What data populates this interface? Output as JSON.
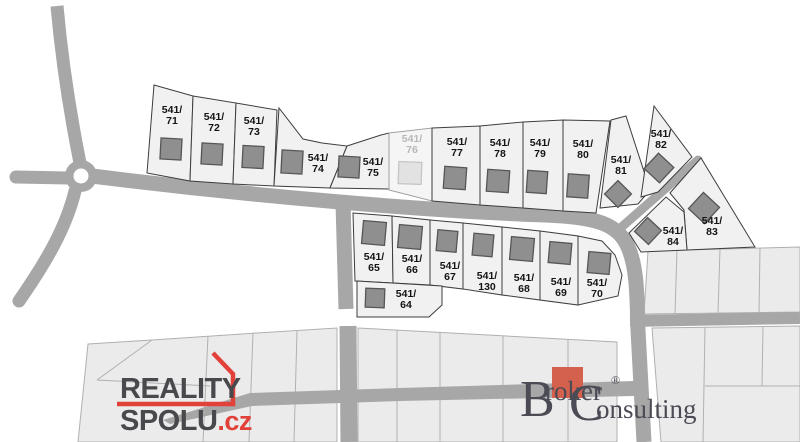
{
  "map": {
    "background": "#ffffff",
    "colors": {
      "road": "#a7a7a7",
      "plot_fill": "#f1f1f1",
      "plot_stroke": "#3d3d3d",
      "building_fill": "#8f8f8f",
      "building_stroke": "#565656",
      "label_color": "#141414",
      "sold_plot_fill": "#f5f5f5",
      "sold_plot_stroke": "#a0a0a0",
      "sold_building_fill": "#e2e2e2",
      "sold_building_stroke": "#c6c6c6",
      "sold_label_color": "#b7b7b7",
      "parcel_fill": "#ebebeb",
      "parcel_stroke": "#b0b0b0",
      "reality_red": "#e2413a",
      "broker_square": "#d4604e",
      "broker_text": "#4b4b55"
    },
    "roundabout": {
      "cx": 81,
      "cy": 176,
      "r_outer": 16,
      "r_inner": 7.5
    },
    "roads": {
      "paths": [
        {
          "d": "M 57,6 C 62,62 71,118 80,163",
          "w": 13
        },
        {
          "d": "M 16,177 L 68,178",
          "w": 13,
          "cap": "round"
        },
        {
          "d": "M 75,191 C 66,228 46,262 19,301",
          "w": 13,
          "cap": "round"
        },
        {
          "d": "M 92,176 C 260,197 430,211 545,215 C 597,217 618,224 628,247 C 637,267 637,295 638,330 L 644,442",
          "w": 15
        },
        {
          "d": "M 343,203 L 346,309",
          "w": 15
        },
        {
          "d": "M 348,326 L 349,442",
          "w": 17
        },
        {
          "d": "M 617,231 L 698,160",
          "w": 9,
          "cap": "round"
        },
        {
          "d": "M 630,321 L 800,318",
          "w": 12
        }
      ],
      "taper_road": [
        [
          163,
          420
        ],
        [
          250,
          393
        ],
        [
          400,
          388
        ],
        [
          634,
          381
        ],
        [
          634,
          396
        ],
        [
          400,
          401
        ],
        [
          252,
          406
        ],
        [
          170,
          424
        ]
      ]
    },
    "parcels": {
      "regions": [
        {
          "pts": [
            [
              88,
              344
            ],
            [
              152,
              340
            ],
            [
              257,
              333
            ],
            [
              337,
              328
            ],
            [
              337,
              442
            ],
            [
              78,
              442
            ]
          ]
        },
        {
          "pts": [
            [
              358,
              328
            ],
            [
              617,
              342
            ],
            [
              617,
              442
            ],
            [
              358,
              442
            ]
          ]
        },
        {
          "pts": [
            [
              648,
              251
            ],
            [
              800,
              247
            ],
            [
              800,
              312
            ],
            [
              644,
              314
            ]
          ]
        },
        {
          "pts": [
            [
              652,
              328
            ],
            [
              800,
              326
            ],
            [
              800,
              442
            ],
            [
              661,
              442
            ]
          ]
        }
      ],
      "lines": [
        [
          [
            152,
            340
          ],
          [
            97,
            380
          ]
        ],
        [
          [
            97,
            380
          ],
          [
            210,
            386
          ]
        ],
        [
          [
            208,
            336
          ],
          [
            203,
            442
          ]
        ],
        [
          [
            253,
            333
          ],
          [
            249,
            442
          ]
        ],
        [
          [
            297,
            331
          ],
          [
            294,
            442
          ]
        ],
        [
          [
            397,
            330
          ],
          [
            397,
            442
          ]
        ],
        [
          [
            440,
            333
          ],
          [
            440,
            442
          ]
        ],
        [
          [
            503,
            336
          ],
          [
            503,
            442
          ]
        ],
        [
          [
            568,
            340
          ],
          [
            568,
            442
          ]
        ],
        [
          [
            677,
            250
          ],
          [
            675,
            313
          ]
        ],
        [
          [
            720,
            249
          ],
          [
            718,
            313
          ]
        ],
        [
          [
            760,
            248
          ],
          [
            759,
            313
          ]
        ],
        [
          [
            705,
            327
          ],
          [
            703,
            442
          ]
        ],
        [
          [
            763,
            327
          ],
          [
            762,
            386
          ]
        ],
        [
          [
            705,
            386
          ],
          [
            800,
            386
          ]
        ]
      ]
    },
    "plots": [
      {
        "label": "541/71",
        "prefix": "541/",
        "suffix": "71",
        "status": "available",
        "poly": [
          [
            154,
            85
          ],
          [
            193,
            96
          ],
          [
            190,
            181
          ],
          [
            147,
            173
          ]
        ],
        "lbl": [
          172,
          113
        ],
        "bld": [
          171,
          149,
          21,
          21,
          3
        ]
      },
      {
        "label": "541/72",
        "prefix": "541/",
        "suffix": "72",
        "status": "available",
        "poly": [
          [
            193,
            96
          ],
          [
            236,
            103
          ],
          [
            233,
            184
          ],
          [
            190,
            181
          ]
        ],
        "lbl": [
          214,
          120
        ],
        "bld": [
          212,
          154,
          21,
          21,
          3
        ]
      },
      {
        "label": "541/73",
        "prefix": "541/",
        "suffix": "73",
        "status": "available",
        "poly": [
          [
            236,
            103
          ],
          [
            277,
            110
          ],
          [
            274,
            186
          ],
          [
            233,
            184
          ]
        ],
        "lbl": [
          254,
          124
        ],
        "bld": [
          253,
          157,
          21,
          22,
          3
        ]
      },
      {
        "label": "541/74",
        "prefix": "541/",
        "suffix": "74",
        "status": "available",
        "poly": [
          [
            279,
            108
          ],
          [
            303,
            139
          ],
          [
            322,
            143
          ],
          [
            347,
            146
          ],
          [
            330,
            188
          ],
          [
            274,
            186
          ]
        ],
        "lbl": [
          318,
          161
        ],
        "bld": [
          292,
          162,
          21,
          23,
          3
        ]
      },
      {
        "label": "541/75",
        "prefix": "541/",
        "suffix": "75",
        "status": "available",
        "poly": [
          [
            347,
            146
          ],
          [
            381,
            135
          ],
          [
            389,
            133
          ],
          [
            389,
            189
          ],
          [
            330,
            188
          ]
        ],
        "lbl": [
          373,
          165
        ],
        "bld": [
          349,
          167,
          21,
          21,
          3
        ]
      },
      {
        "label": "541/76",
        "prefix": "541/",
        "suffix": "76",
        "status": "sold",
        "poly": [
          [
            389,
            133
          ],
          [
            432,
            128
          ],
          [
            432,
            201
          ],
          [
            389,
            190
          ]
        ],
        "lbl": [
          412,
          142
        ],
        "bld": [
          410,
          173,
          23,
          22,
          2
        ]
      },
      {
        "label": "541/77",
        "prefix": "541/",
        "suffix": "77",
        "status": "available",
        "poly": [
          [
            432,
            128
          ],
          [
            480,
            126
          ],
          [
            480,
            205
          ],
          [
            432,
            201
          ]
        ],
        "lbl": [
          457,
          145
        ],
        "bld": [
          455,
          178,
          22,
          22,
          4
        ]
      },
      {
        "label": "541/78",
        "prefix": "541/",
        "suffix": "78",
        "status": "available",
        "poly": [
          [
            480,
            126
          ],
          [
            523,
            122
          ],
          [
            523,
            208
          ],
          [
            480,
            205
          ]
        ],
        "lbl": [
          500,
          146
        ],
        "bld": [
          498,
          181,
          22,
          22,
          4
        ]
      },
      {
        "label": "541/79",
        "prefix": "541/",
        "suffix": "79",
        "status": "available",
        "poly": [
          [
            523,
            122
          ],
          [
            563,
            120
          ],
          [
            563,
            211
          ],
          [
            523,
            208
          ]
        ],
        "lbl": [
          540,
          146
        ],
        "bld": [
          537,
          182,
          20,
          22,
          4
        ]
      },
      {
        "label": "541/80",
        "prefix": "541/",
        "suffix": "80",
        "status": "available",
        "poly": [
          [
            563,
            120
          ],
          [
            610,
            121
          ],
          [
            596,
            213
          ],
          [
            563,
            211
          ]
        ],
        "lbl": [
          583,
          147
        ],
        "bld": [
          578,
          186,
          21,
          23,
          4
        ]
      },
      {
        "label": "541/81",
        "prefix": "541/",
        "suffix": "81",
        "status": "available",
        "poly": [
          [
            611,
            120
          ],
          [
            626,
            116
          ],
          [
            650,
            190
          ],
          [
            638,
            204
          ],
          [
            600,
            208
          ]
        ],
        "lbl": [
          621,
          163
        ],
        "bld": [
          618,
          194,
          19,
          19,
          45
        ]
      },
      {
        "label": "541/82",
        "prefix": "541/",
        "suffix": "82",
        "status": "available",
        "poly": [
          [
            654,
            106
          ],
          [
            692,
            157
          ],
          [
            658,
            192
          ],
          [
            641,
            197
          ]
        ],
        "lbl": [
          661,
          137
        ],
        "bld": [
          659,
          168,
          21,
          21,
          43
        ]
      },
      {
        "label": "541/83",
        "prefix": "541/",
        "suffix": "83",
        "status": "available",
        "poly": [
          [
            670,
            193
          ],
          [
            701,
            158
          ],
          [
            755,
            247
          ],
          [
            687,
            250
          ],
          [
            684,
            210
          ]
        ],
        "lbl": [
          712,
          224
        ],
        "bld": [
          704,
          208,
          22,
          22,
          43
        ]
      },
      {
        "label": "541/84",
        "prefix": "541/",
        "suffix": "84",
        "status": "available",
        "poly": [
          [
            629,
            233
          ],
          [
            666,
            197
          ],
          [
            684,
            212
          ],
          [
            687,
            250
          ],
          [
            641,
            252
          ]
        ],
        "lbl": [
          673,
          234
        ],
        "bld": [
          648,
          231,
          19,
          19,
          43
        ]
      },
      {
        "label": "541/65",
        "prefix": "541/",
        "suffix": "65",
        "status": "available",
        "poly": [
          [
            353,
            213
          ],
          [
            392,
            216
          ],
          [
            393,
            283
          ],
          [
            355,
            281
          ]
        ],
        "lbl": [
          374,
          260
        ],
        "bld": [
          374,
          233,
          23,
          23,
          5
        ]
      },
      {
        "label": "541/66",
        "prefix": "541/",
        "suffix": "66",
        "status": "available",
        "poly": [
          [
            392,
            216
          ],
          [
            430,
            220
          ],
          [
            430,
            285
          ],
          [
            393,
            283
          ]
        ],
        "lbl": [
          412,
          262
        ],
        "bld": [
          410,
          237,
          23,
          23,
          5
        ]
      },
      {
        "label": "541/67",
        "prefix": "541/",
        "suffix": "67",
        "status": "available",
        "poly": [
          [
            430,
            220
          ],
          [
            463,
            223
          ],
          [
            463,
            289
          ],
          [
            430,
            285
          ]
        ],
        "lbl": [
          450,
          269
        ],
        "bld": [
          447,
          241,
          20,
          21,
          5
        ]
      },
      {
        "label": "541/130",
        "prefix": "541/",
        "suffix": "130",
        "status": "available",
        "poly": [
          [
            463,
            223
          ],
          [
            502,
            227
          ],
          [
            502,
            295
          ],
          [
            463,
            289
          ]
        ],
        "lbl": [
          487,
          279
        ],
        "bld": [
          483,
          245,
          20,
          22,
          5
        ]
      },
      {
        "label": "541/68",
        "prefix": "541/",
        "suffix": "68",
        "status": "available",
        "poly": [
          [
            502,
            227
          ],
          [
            540,
            231
          ],
          [
            540,
            300
          ],
          [
            502,
            295
          ]
        ],
        "lbl": [
          524,
          281
        ],
        "bld": [
          522,
          249,
          23,
          23,
          5
        ]
      },
      {
        "label": "541/69",
        "prefix": "541/",
        "suffix": "69",
        "status": "available",
        "poly": [
          [
            540,
            231
          ],
          [
            578,
            236
          ],
          [
            578,
            305
          ],
          [
            540,
            300
          ]
        ],
        "lbl": [
          561,
          285
        ],
        "bld": [
          560,
          253,
          22,
          21,
          5
        ]
      },
      {
        "label": "541/70",
        "prefix": "541/",
        "suffix": "70",
        "status": "available",
        "poly": [
          [
            578,
            236
          ],
          [
            602,
            241
          ],
          [
            615,
            255
          ],
          [
            622,
            275
          ],
          [
            618,
            296
          ],
          [
            578,
            305
          ]
        ],
        "lbl": [
          597,
          286
        ],
        "bld": [
          599,
          263,
          22,
          21,
          5
        ]
      },
      {
        "label": "541/64",
        "prefix": "541/",
        "suffix": "64",
        "status": "available",
        "poly": [
          [
            357,
            281
          ],
          [
            442,
            286
          ],
          [
            442,
            305
          ],
          [
            429,
            317
          ],
          [
            357,
            317
          ]
        ],
        "lbl": [
          406,
          297
        ],
        "bld": [
          375,
          298,
          19,
          19,
          2
        ]
      }
    ]
  },
  "watermarks": {
    "reality_spolu": {
      "line1": "REALITY",
      "line2": "SPOLU",
      "tld": ".cz"
    },
    "broker": {
      "initial_b": "B",
      "word_b_rest": "roker",
      "registered": "®",
      "initial_c": "C",
      "word_c_rest": "onsulting"
    }
  }
}
